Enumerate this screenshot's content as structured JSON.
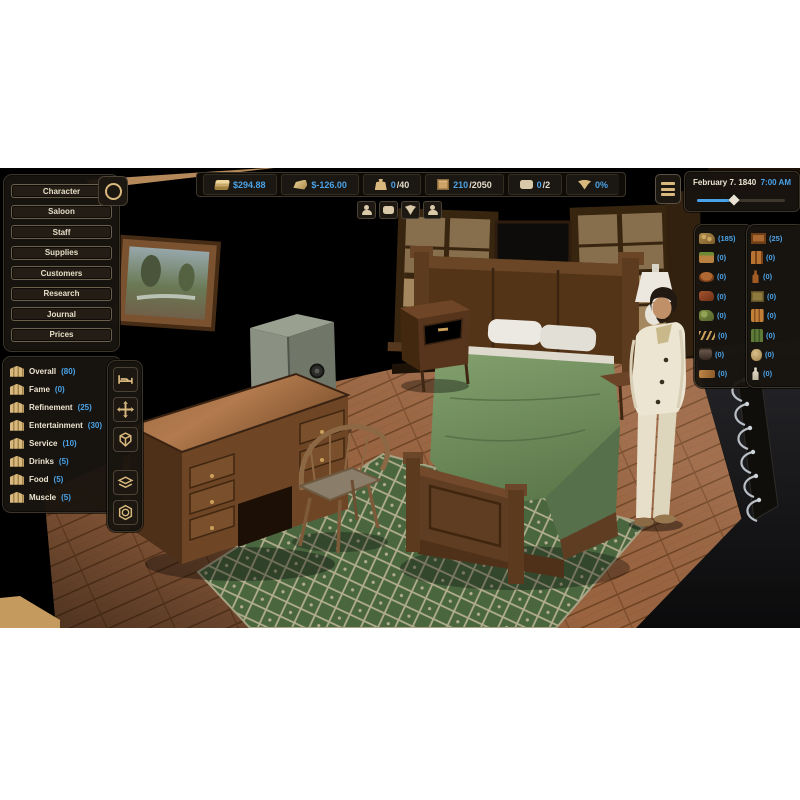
{
  "colors": {
    "accent_blue": "#4aa3e8",
    "gold": "#d9b87e",
    "panel_bg": "#18140f"
  },
  "sidebar_menu": {
    "items": [
      "Character",
      "Saloon",
      "Staff",
      "Supplies",
      "Customers",
      "Research",
      "Journal",
      "Prices"
    ]
  },
  "top_bar": {
    "cash": "$294.88",
    "daily_profit": "$-126.00",
    "bag_current": "0",
    "bag_max": "/40",
    "storage_current": "210",
    "storage_max": "/2050",
    "messages_current": "0",
    "messages_max": "/2",
    "threat_percent": "0%",
    "icons": [
      "cash-icon",
      "gold-bar-icon",
      "bag-icon",
      "crate-icon",
      "speech-bubble-icon",
      "bandana-icon"
    ]
  },
  "mini_buttons": {
    "icons": [
      "customers-icon",
      "chat-icon",
      "bandana-icon",
      "staff-icon"
    ]
  },
  "clock": {
    "date": "February 7. 1840",
    "time": "7:00 AM",
    "slider_percent": 42
  },
  "stats": {
    "items": [
      {
        "label": "Overall",
        "value": "(80)"
      },
      {
        "label": "Fame",
        "value": "(0)"
      },
      {
        "label": "Refinement",
        "value": "(25)"
      },
      {
        "label": "Entertainment",
        "value": "(30)"
      },
      {
        "label": "Service",
        "value": "(10)"
      },
      {
        "label": "Drinks",
        "value": "(5)"
      },
      {
        "label": "Food",
        "value": "(5)"
      },
      {
        "label": "Muscle",
        "value": "(5)"
      }
    ]
  },
  "supplies": {
    "food": {
      "icons": [
        "hay-sack-icon",
        "vegetables-icon",
        "roast-meat-icon",
        "raw-meat-icon",
        "cabbage-icon",
        "skewers-icon",
        "cooking-pot-icon",
        "cutting-board-icon"
      ],
      "counts": [
        "(185)",
        "(0)",
        "(0)",
        "(0)",
        "(0)",
        "(0)",
        "(0)",
        "(0)"
      ]
    },
    "drinks": {
      "icons": [
        "beer-crate-icon",
        "beer-bottles-icon",
        "whiskey-bottle-icon",
        "liquor-box-icon",
        "beer-pack-icon",
        "wine-bottles-icon",
        "cider-jug-icon",
        "moonshine-jug-icon"
      ],
      "counts": [
        "(25)",
        "(0)",
        "(0)",
        "(0)",
        "(0)",
        "(0)",
        "(0)",
        "(0)"
      ]
    }
  },
  "toolbar": {
    "icons": [
      "bed-icon",
      "move-cross-icon",
      "cube-icon",
      "layers-icon",
      "coin-hex-icon"
    ]
  }
}
